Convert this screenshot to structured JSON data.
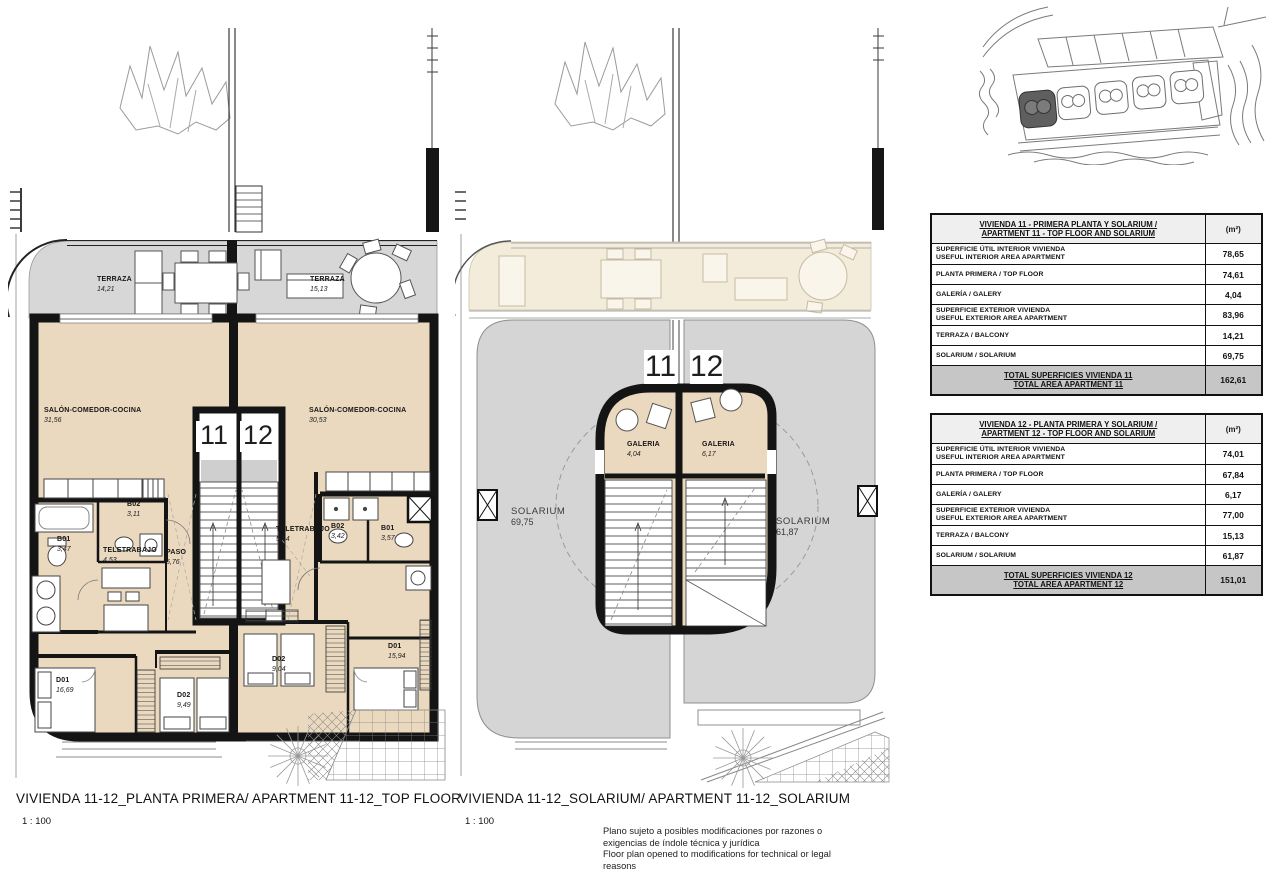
{
  "sheet": {
    "captions": [
      {
        "title": "VIVIENDA 11-12_PLANTA PRIMERA/ APARTMENT 11-12_TOP FLOOR",
        "scale": "1 : 100"
      },
      {
        "title": "VIVIENDA 11-12_SOLARIUM/ APARTMENT 11-12_SOLARIUM",
        "scale": "1 : 100"
      }
    ],
    "disclaimer": [
      "Plano sujeto a posibles modificaciones por razones o",
      "exigencias de índole técnica y jurídica",
      "Floor plan opened to modifications for technical or legal",
      "reasons"
    ]
  },
  "plan_top_floor": {
    "unit_left": "11",
    "unit_right": "12",
    "rooms": {
      "terraza_left": {
        "name": "TERRAZA",
        "area": "14,21"
      },
      "terraza_right": {
        "name": "TERRAZA",
        "area": "15,13"
      },
      "salon_left": {
        "name": "SALÓN-COMEDOR-COCINA",
        "area": "31,56"
      },
      "salon_right": {
        "name": "SALÓN-COMEDOR-COCINA",
        "area": "30,53"
      },
      "b02_left": {
        "name": "B02",
        "area": "3,11"
      },
      "b01_left": {
        "name": "B01",
        "area": "3,47"
      },
      "teletrabajo_left": {
        "name": "TELETRABAJO",
        "area": "4,53"
      },
      "paso_left": {
        "name": "PASO",
        "area": "5,76"
      },
      "teletrabajo_right": {
        "name": "TELETRABAJO",
        "area": "5,94"
      },
      "b02_right": {
        "name": "B02",
        "area": "3,42"
      },
      "b01_right": {
        "name": "B01",
        "area": "3,57"
      },
      "d01_left": {
        "name": "D01",
        "area": "16,69"
      },
      "d02_left": {
        "name": "D02",
        "area": "9,49"
      },
      "d02_right": {
        "name": "D02",
        "area": "9,04"
      },
      "d01_right": {
        "name": "D01",
        "area": "15,94"
      }
    }
  },
  "plan_solarium": {
    "unit_left": "11",
    "unit_right": "12",
    "rooms": {
      "galeria_left": {
        "name": "GALERIA",
        "area": "4,04"
      },
      "galeria_right": {
        "name": "GALERIA",
        "area": "6,17"
      },
      "solarium_left": {
        "name": "SOLARIUM",
        "area": "69,75"
      },
      "solarium_right": {
        "name": "SOLARIUM",
        "area": "61,87"
      }
    }
  },
  "tables": [
    {
      "title_line1": "VIVIENDA 11 - PRIMERA PLANTA Y SOLARIUM /",
      "title_line2": "APARTMENT 11 - TOP FLOOR AND SOLARIUM",
      "unit_header": "(m²)",
      "rows": [
        {
          "line1": "SUPERFICIE ÚTIL INTERIOR VIVIENDA",
          "line2": "USEFUL INTERIOR AREA APARTMENT",
          "value": "78,65"
        },
        {
          "line1": "PLANTA PRIMERA / TOP FLOOR",
          "line2": "",
          "value": "74,61"
        },
        {
          "line1": "GALERÍA / GALERY",
          "line2": "",
          "value": "4,04"
        },
        {
          "line1": "SUPERFICIE EXTERIOR VIVIENDA",
          "line2": "USEFUL EXTERIOR AREA APARTMENT",
          "value": "83,96"
        },
        {
          "line1": "TERRAZA / BALCONY",
          "line2": "",
          "value": "14,21"
        },
        {
          "line1": "SOLARIUM / SOLARIUM",
          "line2": "",
          "value": "69,75"
        }
      ],
      "total_line1": "TOTAL SUPERFICIES VIVIENDA 11",
      "total_line2": "TOTAL AREA APARTMENT 11",
      "total_value": "162,61"
    },
    {
      "title_line1": "VIVIENDA 12 - PLANTA PRIMERA Y SOLARIUM /",
      "title_line2": "APARTMENT 12 - TOP FLOOR AND SOLARIUM",
      "unit_header": "(m²)",
      "rows": [
        {
          "line1": "SUPERFICIE ÚTIL INTERIOR VIVIENDA",
          "line2": "USEFUL INTERIOR AREA APARTMENT",
          "value": "74,01"
        },
        {
          "line1": "PLANTA PRIMERA / TOP FLOOR",
          "line2": "",
          "value": "67,84"
        },
        {
          "line1": "GALERÍA / GALERY",
          "line2": "",
          "value": "6,17"
        },
        {
          "line1": "SUPERFICIE EXTERIOR VIVIENDA",
          "line2": "USEFUL EXTERIOR AREA APARTMENT",
          "value": "77,00"
        },
        {
          "line1": "TERRAZA / BALCONY",
          "line2": "",
          "value": "15,13"
        },
        {
          "line1": "SOLARIUM / SOLARIUM",
          "line2": "",
          "value": "61,87"
        }
      ],
      "total_line1": "TOTAL SUPERFICIES VIVIENDA 12",
      "total_line2": "TOTAL AREA APARTMENT 12",
      "total_value": "151,01"
    }
  ],
  "colors": {
    "interior_fill": "#EAD9BF",
    "terrace_fill": "#D7D7D7",
    "solarium_fill": "#D5D5D5",
    "ghost_fill": "#F4ECDB",
    "wall": "#141414",
    "table_header_fill": "#EFEFEF",
    "table_total_fill": "#C6C6C6",
    "site_highlight": "#5F5F5F"
  }
}
